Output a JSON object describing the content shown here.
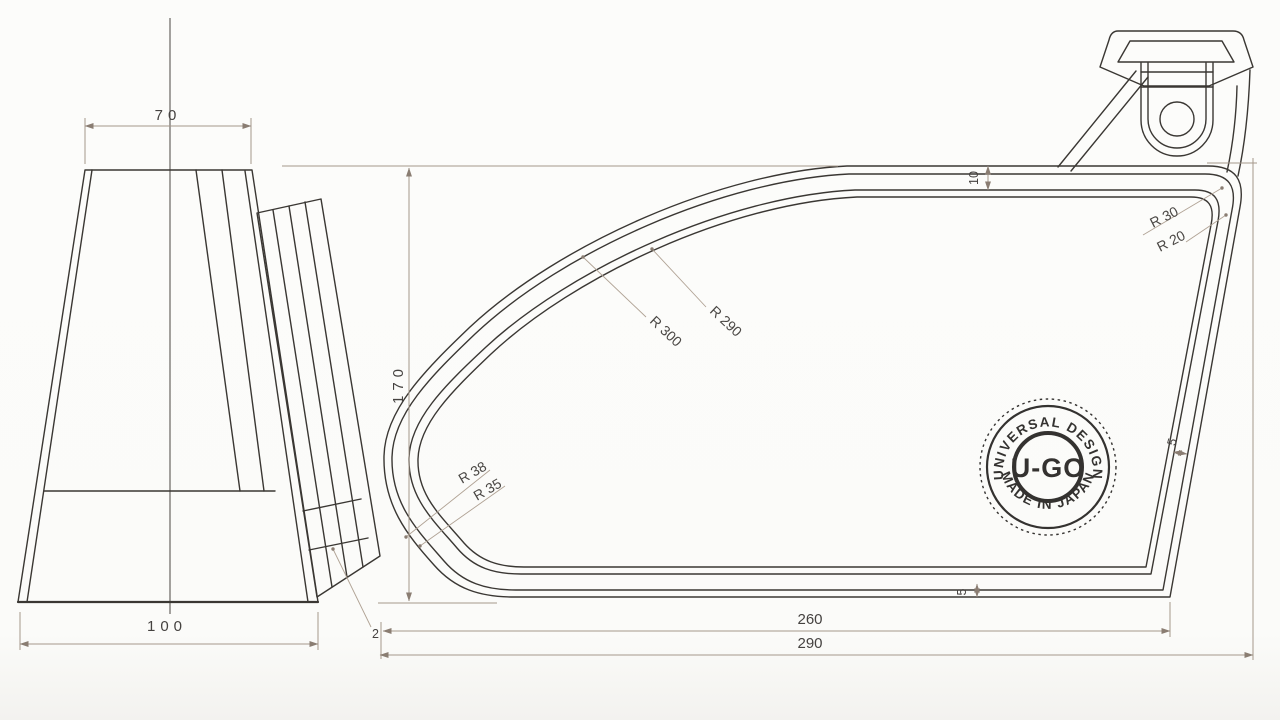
{
  "front_view": {
    "dim_top_width": "70",
    "dim_bottom_width": "100",
    "edge_thickness_label": "2"
  },
  "side_view": {
    "dim_height": "170",
    "dim_rim_depth": "10",
    "dim_wall_gap": "5",
    "dim_bottom_gap": "5",
    "dim_base_width": "260",
    "dim_overall_width": "290",
    "radii": {
      "sweep_outer": "R 300",
      "sweep_inner": "R 290",
      "top_corner_outer": "R 30",
      "top_corner_inner": "R 20",
      "heel_outer": "R 38",
      "heel_inner": "R 35"
    }
  },
  "stamp": {
    "arc_top": "UNIVERSAL DESIGN",
    "arc_bottom": "MADE IN JAPAN",
    "center": "U-GO"
  },
  "colors": {
    "line": "#3a3733",
    "dim_line": "#a5988b",
    "dim_text": "#454240",
    "stamp": "#343230",
    "background": "#fbfbf9"
  }
}
